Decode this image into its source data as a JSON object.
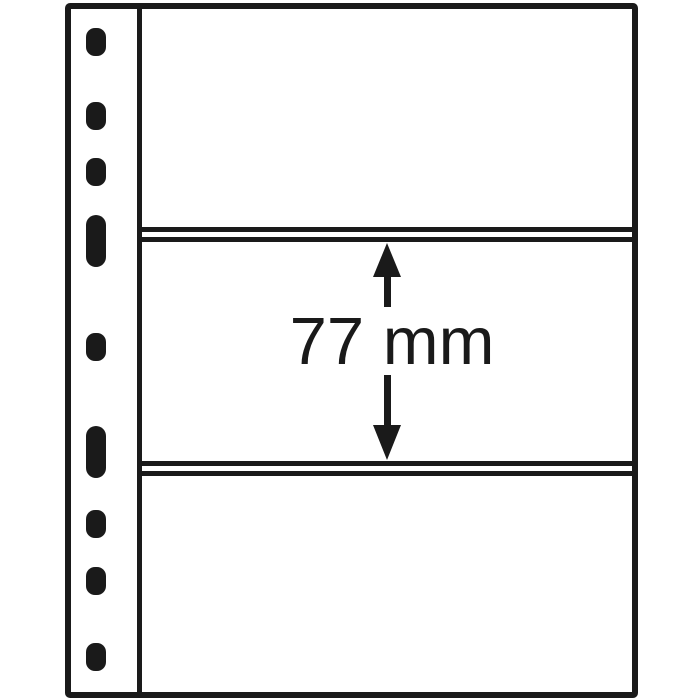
{
  "figure": {
    "kind": "binder-sheet-diagram",
    "pocket_count": 3
  },
  "annotation": {
    "label": "77 mm"
  },
  "sheet": {
    "holes": {
      "center_x": 96,
      "round": {
        "width": 20,
        "height": 28
      },
      "slot": {
        "width": 20,
        "height": 52
      },
      "items": [
        {
          "type": "round",
          "cy": 42
        },
        {
          "type": "round",
          "cy": 116
        },
        {
          "type": "round",
          "cy": 172
        },
        {
          "type": "slot",
          "cy": 241
        },
        {
          "type": "round",
          "cy": 347
        },
        {
          "type": "slot",
          "cy": 452
        },
        {
          "type": "round",
          "cy": 524
        },
        {
          "type": "round",
          "cy": 581
        },
        {
          "type": "round",
          "cy": 657
        }
      ]
    },
    "dividers": [
      {
        "line1_y": 227,
        "line2_y": 237,
        "thickness": 5
      },
      {
        "line1_y": 461,
        "line2_y": 471,
        "thickness": 5
      }
    ]
  },
  "colors": {
    "ink": "#1a1a1a",
    "background": "#ffffff"
  }
}
